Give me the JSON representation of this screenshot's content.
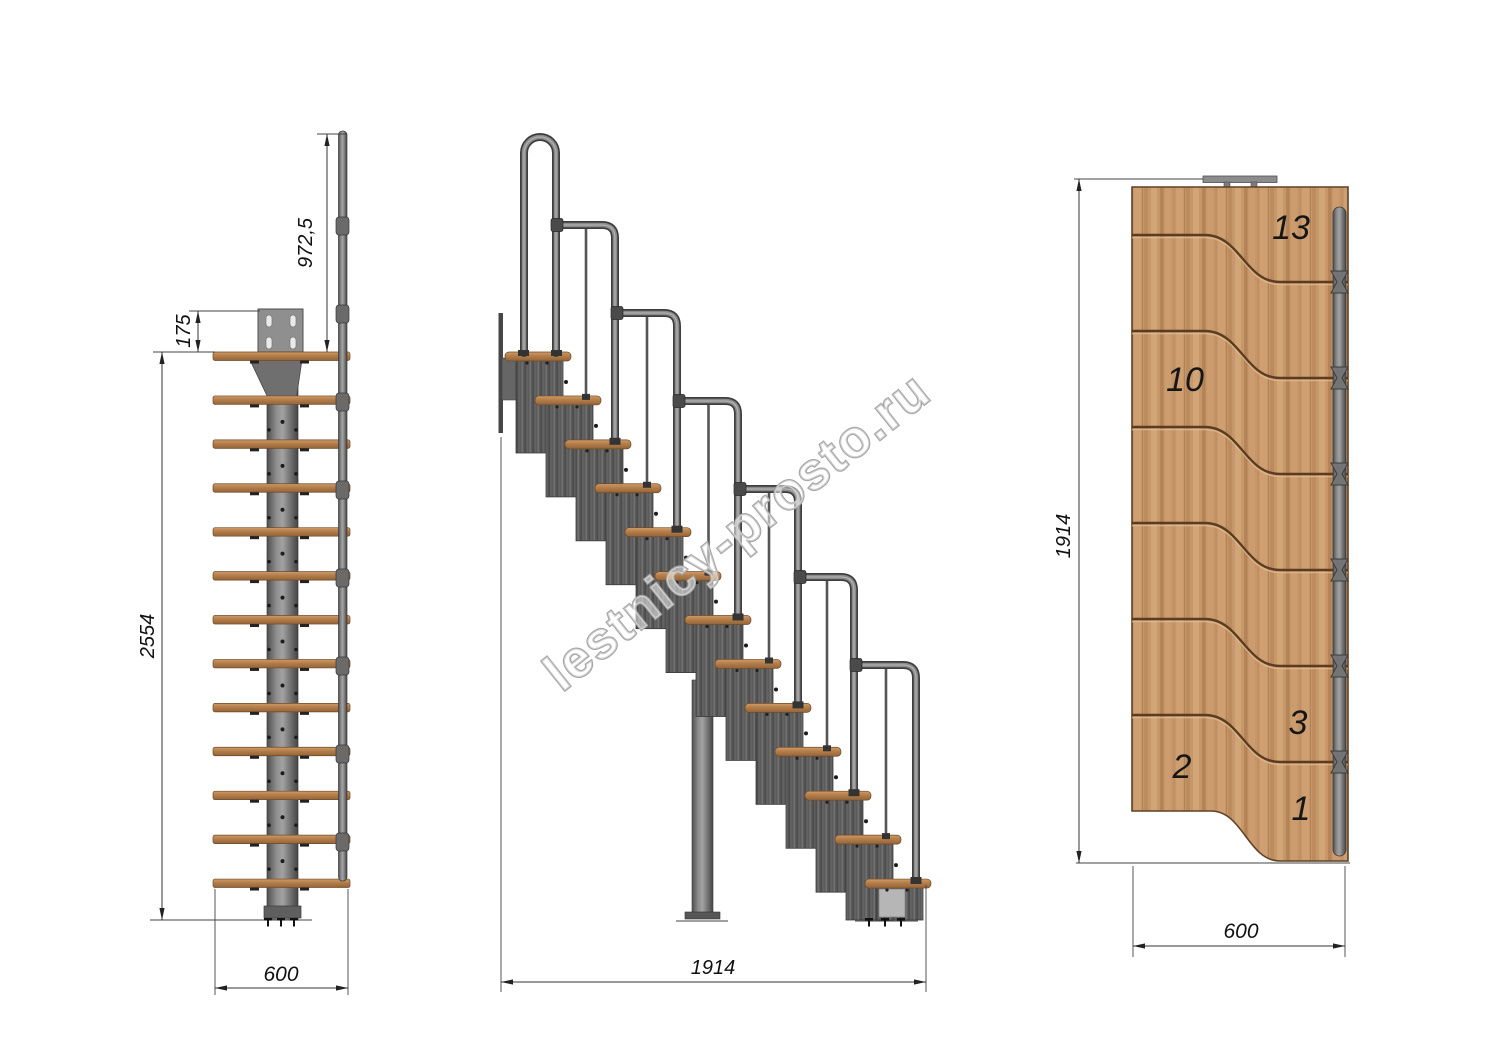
{
  "watermark": "lestnicy-prosto.ru",
  "front_view": {
    "dim_handrail_height": "972,5",
    "dim_top_offset": "175",
    "dim_total_height": "2554",
    "dim_width": "600"
  },
  "side_view": {
    "dim_length": "1914"
  },
  "plan_view": {
    "dim_length": "1914",
    "dim_width": "600",
    "step_labels": {
      "s13": "13",
      "s10": "10",
      "s3": "3",
      "s2": "2",
      "s1": "1"
    }
  },
  "colors": {
    "wood_tread": "#b5804c",
    "plan_wood": "#c6976a",
    "groove": "#5a3c22",
    "metal_light": "#a0a0a0",
    "metal_mid": "#787878",
    "metal_dark": "#454545",
    "dimension_line": "#333333",
    "text": "#111111",
    "watermark_outline": "#a5a5a5"
  }
}
